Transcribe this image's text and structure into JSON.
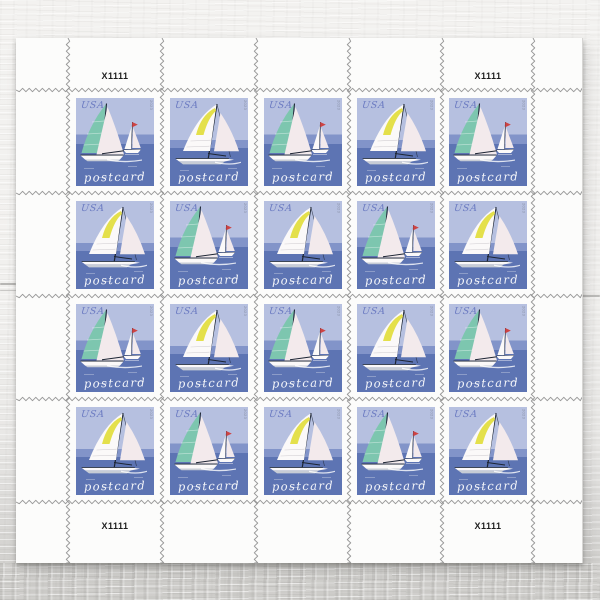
{
  "sheet": {
    "plate_number": "X1111",
    "plate_number_positions": [
      "top-left",
      "top-right",
      "bottom-left",
      "bottom-right"
    ],
    "grid": {
      "rows": 4,
      "cols": 5,
      "pattern": [
        [
          "A",
          "B",
          "A",
          "B",
          "A"
        ],
        [
          "B",
          "A",
          "B",
          "A",
          "B"
        ],
        [
          "A",
          "B",
          "A",
          "B",
          "A"
        ],
        [
          "B",
          "A",
          "B",
          "A",
          "B"
        ]
      ]
    },
    "stamp": {
      "country_label": "USA",
      "denomination_label": "postcard",
      "year_microprint": "2023",
      "designs": {
        "A": "two-sailboats-teal-mainsail-with-small-red-pennant-boat",
        "B": "single-sailboat-white-mainsail-with-yellow-panel"
      }
    },
    "colors": {
      "sky": "#b6c0e0",
      "horizon_band": "#8294c9",
      "water": "#5d74b3",
      "teal_sail": "#7dc6af",
      "yellow_sail": "#e4e04b",
      "pink_sail": "#f3eaec",
      "white_sail": "#fbf9f9",
      "red_pennant": "#ce4343",
      "mast": "#1d2534",
      "hull_gray": "#c7ccd5",
      "usa_text": "#6d7cc2",
      "postcard_text": "#ffffff",
      "paper": "#fcfcfb",
      "perforation": "#8e8e8e"
    }
  }
}
